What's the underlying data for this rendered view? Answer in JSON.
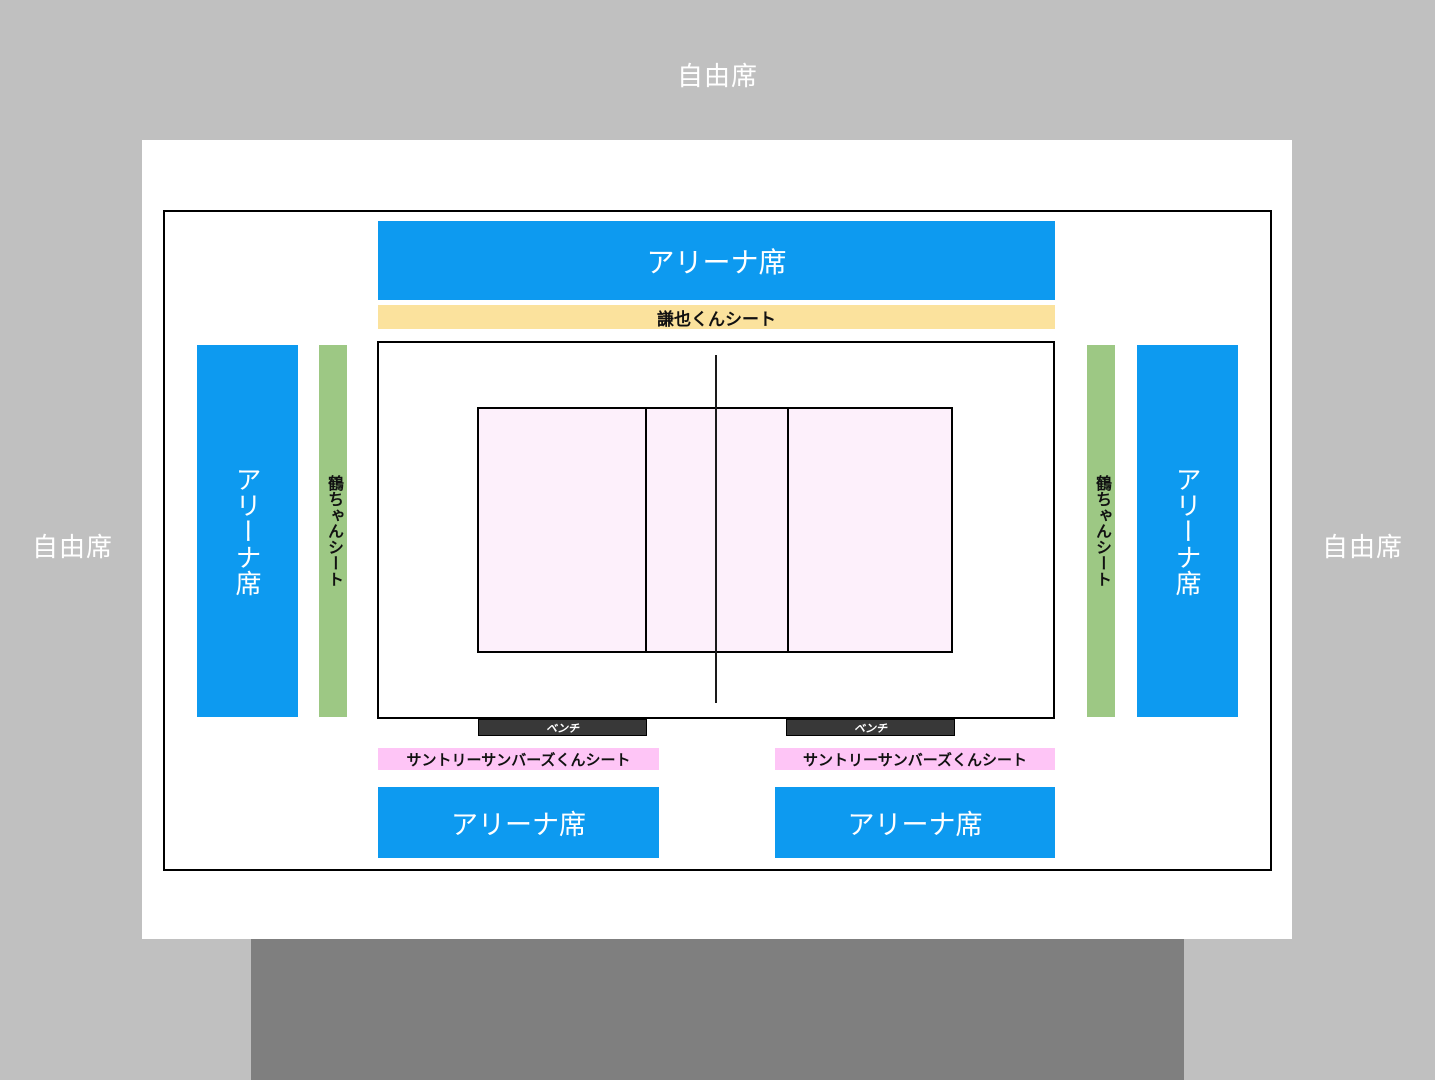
{
  "page": {
    "background_color": "#c0c0c0",
    "stage_color": "#7f7f7f",
    "board_color": "#ffffff"
  },
  "outer_area": {
    "top_label": "自由席",
    "left_label": "自由席",
    "right_label": "自由席"
  },
  "zones": {
    "arena_top": {
      "label": "アリーナ席",
      "color": "#0d9af0"
    },
    "kenya_sheet": {
      "label": "謙也くんシート",
      "color": "#fbe29d"
    },
    "arena_left": {
      "label": "アリーナ席",
      "color": "#0d9af0"
    },
    "arena_right": {
      "label": "アリーナ席",
      "color": "#0d9af0"
    },
    "tsuru_sheet_left": {
      "label": "鶴ちゃんシート",
      "color": "#9dc884"
    },
    "tsuru_sheet_right": {
      "label": "鶴ちゃんシート",
      "color": "#9dc884"
    },
    "bench_left": {
      "label": "ベンチ",
      "color": "#383838"
    },
    "bench_right": {
      "label": "ベンチ",
      "color": "#383838"
    },
    "sunbirds_sheet_left": {
      "label": "サントリーサンバーズくんシート",
      "color": "#fec5f6"
    },
    "sunbirds_sheet_right": {
      "label": "サントリーサンバーズくんシート",
      "color": "#fec5f6"
    },
    "arena_bottom_left": {
      "label": "アリーナ席",
      "color": "#0d9af0"
    },
    "arena_bottom_right": {
      "label": "アリーナ席",
      "color": "#0d9af0"
    }
  },
  "court": {
    "fill_color": "#fdf0fb",
    "line_color": "#000000"
  }
}
